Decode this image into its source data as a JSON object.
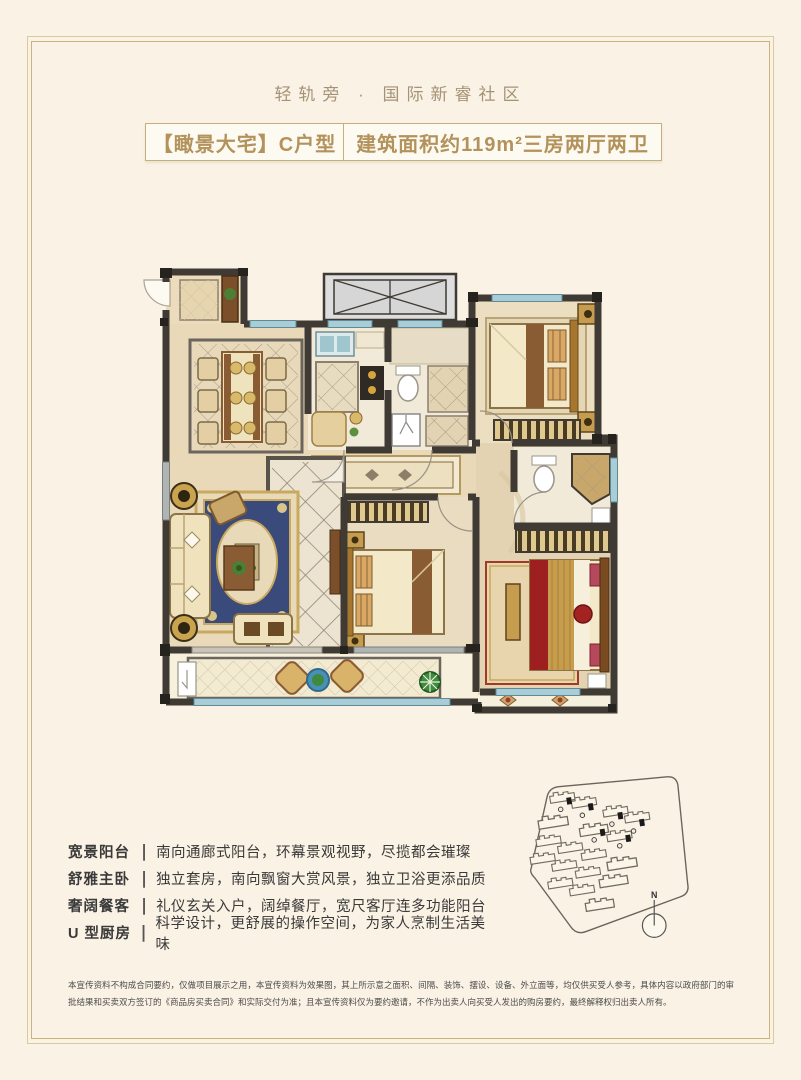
{
  "page": {
    "header": "轻轨旁 · 国际新睿社区",
    "title_left": "【瞰景大宅】C户型",
    "title_right": "建筑面积约119m²三房两厅两卫"
  },
  "features": [
    {
      "label": "宽景阳台",
      "desc": "南向通廊式阳台，环幕景观视野，尽揽都会璀璨"
    },
    {
      "label": "舒雅主卧",
      "desc": "独立套房，南向飘窗大赏风景，独立卫浴更添品质"
    },
    {
      "label": "奢阔餐客",
      "desc": "礼仪玄关入户，阔绰餐厅，宽尺客厅连多功能阳台"
    },
    {
      "label": "U 型厨房",
      "desc": "科学设计，更舒展的操作空间，为家人烹制生活美味"
    }
  ],
  "separator": "|",
  "site_plan": {
    "compass_label": "N"
  },
  "disclaimer": "本宣传资料不构成合同要约，仅做项目展示之用，本宣传资料为效果图，其上所示意之面积、间隔、装饰、摆设、设备、外立面等，均仅供买受人参考，具体内容以政府部门的审批结果和买卖双方签订的《商品房买卖合同》和实际交付为准；且本宣传资料仅为要约邀请，不作为出卖人向买受人发出的购房要约，最终解释权归出卖人所有。",
  "colors": {
    "background": "#faf2e4",
    "frame_line": "#dbc89f",
    "accent_gold": "#b3925c",
    "text_dark": "#3a3a3a",
    "wall": "#3f3a33",
    "window_blue": "#a9cdd6",
    "bed_red": "#9e1f1f"
  }
}
